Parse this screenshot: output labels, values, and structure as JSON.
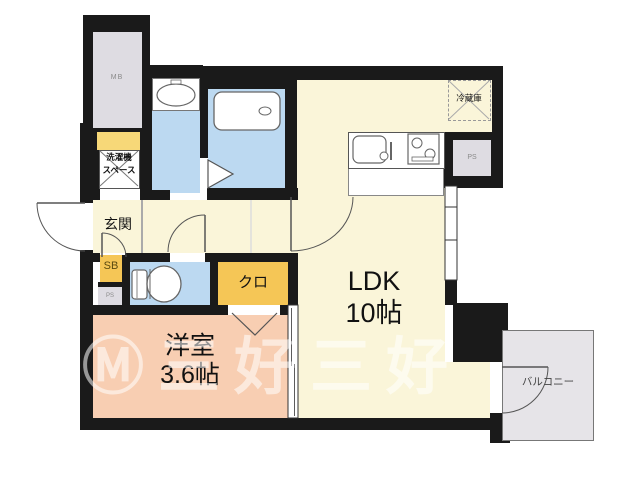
{
  "floorplan": {
    "rooms": {
      "ldk": {
        "name": "LDK",
        "size": "10帖"
      },
      "western_room": {
        "name": "洋室",
        "size": "3.6帖"
      },
      "entrance": {
        "label": "玄関"
      },
      "closet": {
        "label": "クロ"
      },
      "balcony": {
        "label": "バルコニー"
      },
      "laundry_space": {
        "line1": "洗濯機",
        "line2": "スペース"
      },
      "refrigerator": {
        "label": "冷蔵庫"
      },
      "meter_box": {
        "label": "MB"
      },
      "pipe_space_left": {
        "label": "PS"
      },
      "pipe_space_right": {
        "label": "PS"
      },
      "shoe_box": {
        "label": "SB"
      }
    },
    "watermark": {
      "text": "Ⓜ三好三好"
    },
    "colors": {
      "wall": "#1a1a1a",
      "room_yellow": "#FAF5D9",
      "room_pink": "#F8CEB2",
      "wet_area_blue": "#BCD9F1",
      "storage_orange": "#F5C656",
      "service_gray": "#DEDCE2",
      "balcony_gray": "#E6E4E8",
      "accent_gold": "#F7D878"
    }
  }
}
